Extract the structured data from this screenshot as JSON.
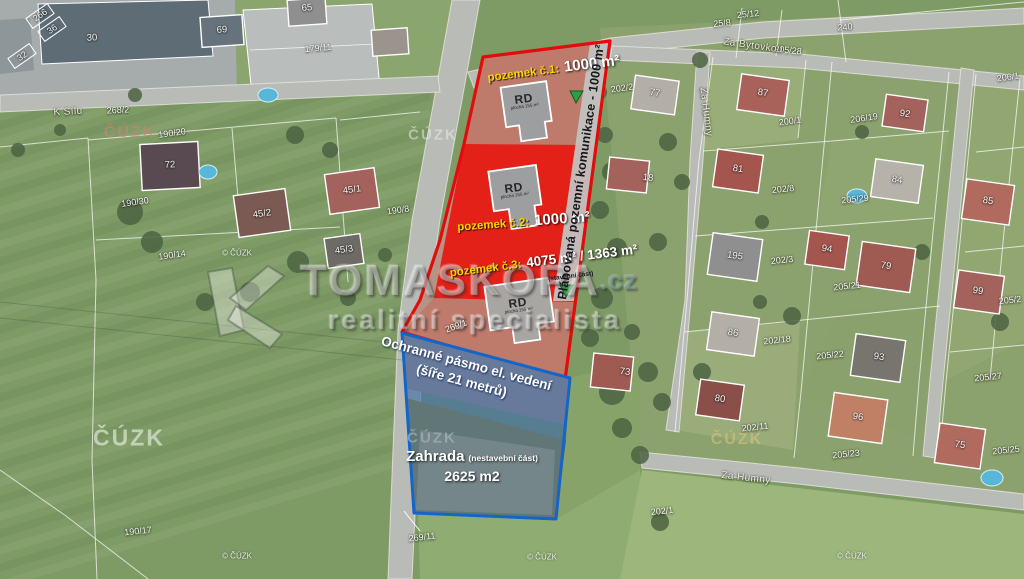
{
  "map_overlay": {
    "parcel1_label": "pozemek č.1:",
    "parcel1_area": "1000 m²",
    "parcel2_label": "pozemek č.2:",
    "parcel2_area": "1000 m²",
    "parcel3_label": "pozemek č.3:",
    "parcel3_area": "4075 m² / 1363 m²",
    "parcel3_note": "(stavební část)",
    "planned_road_label": "Plánovaná pozemní komunikace - 1000 m²",
    "easement_line1": "Ochranné pásmo el. vedení",
    "easement_line2": "(šíře 21 metrů)",
    "garden_title": "Zahrada",
    "garden_note": "(nestavební část)",
    "garden_area": "2625 m2",
    "building_label": "RD",
    "building_sublabel": "plocha 155 m²",
    "colors": {
      "parcel_outline": "#e30c0c",
      "parcel2_fill": "#e32119",
      "garden_outline": "#1565c8",
      "road_strip": "#c2c2c0",
      "marker_green": "#2e9e41",
      "label_yellow": "#ffd400"
    }
  },
  "watermark": {
    "brand": "TOMASKOPA",
    "tld": ".cz",
    "tagline": "realitní specialista"
  },
  "cuzk": {
    "watermark_text": "ČÚZK",
    "copyright_text": "© ČÚZK",
    "watermark_positions": [
      {
        "x": 130,
        "y": 133,
        "size": 16,
        "color": "rgba(205,130,120,0.6)"
      },
      {
        "x": 433,
        "y": 135,
        "size": 15,
        "color": "rgba(240,240,240,0.5)"
      },
      {
        "x": 129,
        "y": 438,
        "size": 23,
        "color": "rgba(235,240,230,0.62)"
      },
      {
        "x": 432,
        "y": 438,
        "size": 15,
        "color": "rgba(175,185,190,0.62)"
      },
      {
        "x": 737,
        "y": 440,
        "size": 16,
        "color": "rgba(215,195,125,0.6)"
      }
    ],
    "copyright_positions": [
      {
        "x": 237,
        "y": 253
      },
      {
        "x": 237,
        "y": 556
      },
      {
        "x": 542,
        "y": 557
      },
      {
        "x": 852,
        "y": 556
      }
    ]
  },
  "cadastre": {
    "street_labels": [
      {
        "text": "Za Bytovkou",
        "x": 753,
        "y": 46,
        "rot": 8
      },
      {
        "text": "Za Humny",
        "x": 706,
        "y": 112,
        "rot": 83
      },
      {
        "text": "Za Humny",
        "x": 746,
        "y": 478,
        "rot": 6
      },
      {
        "text": "K Sílu",
        "x": 68,
        "y": 112,
        "rot": -3
      }
    ],
    "parcel_labels": [
      {
        "text": "25/12",
        "x": 748,
        "y": 14,
        "rot": -6
      },
      {
        "text": "25/8",
        "x": 722,
        "y": 23,
        "rot": -6
      },
      {
        "text": "205/28",
        "x": 788,
        "y": 50,
        "rot": 6
      },
      {
        "text": "240",
        "x": 845,
        "y": 27,
        "rot": -5
      },
      {
        "text": "202/2",
        "x": 622,
        "y": 88,
        "rot": -8
      },
      {
        "text": "200/1",
        "x": 790,
        "y": 121,
        "rot": -8
      },
      {
        "text": "206/1",
        "x": 1008,
        "y": 77,
        "rot": -8
      },
      {
        "text": "206/19",
        "x": 864,
        "y": 118,
        "rot": -8
      },
      {
        "text": "179/11",
        "x": 318,
        "y": 48,
        "rot": -5
      },
      {
        "text": "268/2",
        "x": 118,
        "y": 110,
        "rot": -3
      },
      {
        "text": "190/20",
        "x": 172,
        "y": 133,
        "rot": -8
      },
      {
        "text": "190/30",
        "x": 135,
        "y": 202,
        "rot": -8
      },
      {
        "text": "190/8",
        "x": 398,
        "y": 210,
        "rot": -8
      },
      {
        "text": "190/14",
        "x": 172,
        "y": 255,
        "rot": -8
      },
      {
        "text": "202/8",
        "x": 783,
        "y": 189,
        "rot": -6
      },
      {
        "text": "205/29",
        "x": 855,
        "y": 199,
        "rot": -6
      },
      {
        "text": "202/3",
        "x": 782,
        "y": 260,
        "rot": -6
      },
      {
        "text": "205/21",
        "x": 847,
        "y": 286,
        "rot": -6
      },
      {
        "text": "205/2",
        "x": 1010,
        "y": 300,
        "rot": -6
      },
      {
        "text": "202/18",
        "x": 777,
        "y": 340,
        "rot": -6
      },
      {
        "text": "205/22",
        "x": 830,
        "y": 355,
        "rot": -6
      },
      {
        "text": "205/27",
        "x": 988,
        "y": 377,
        "rot": -6
      },
      {
        "text": "202/11",
        "x": 755,
        "y": 427,
        "rot": -6
      },
      {
        "text": "205/23",
        "x": 846,
        "y": 454,
        "rot": -6
      },
      {
        "text": "205/25",
        "x": 1006,
        "y": 450,
        "rot": -6
      },
      {
        "text": "269/1",
        "x": 456,
        "y": 326,
        "rot": -20
      },
      {
        "text": "269/11",
        "x": 422,
        "y": 537,
        "rot": -6
      },
      {
        "text": "202/1",
        "x": 662,
        "y": 511,
        "rot": -6
      },
      {
        "text": "190/17",
        "x": 138,
        "y": 531,
        "rot": -6
      },
      {
        "text": "266",
        "x": 40,
        "y": 15,
        "rot": -35
      },
      {
        "text": "36",
        "x": 52,
        "y": 29,
        "rot": -35
      },
      {
        "text": "32",
        "x": 22,
        "y": 56,
        "rot": -35
      }
    ],
    "house_labels": [
      {
        "text": "30",
        "x": 92,
        "y": 38,
        "rot": -3
      },
      {
        "text": "69",
        "x": 222,
        "y": 30,
        "rot": -4
      },
      {
        "text": "65",
        "x": 307,
        "y": 8,
        "rot": -4
      },
      {
        "text": "72",
        "x": 170,
        "y": 165,
        "rot": -3
      },
      {
        "text": "45/1",
        "x": 352,
        "y": 190,
        "rot": -8
      },
      {
        "text": "45/2",
        "x": 262,
        "y": 214,
        "rot": -8
      },
      {
        "text": "45/3",
        "x": 344,
        "y": 250,
        "rot": -8
      },
      {
        "text": "77",
        "x": 655,
        "y": 93,
        "rot": 8
      },
      {
        "text": "87",
        "x": 763,
        "y": 93,
        "rot": 8
      },
      {
        "text": "92",
        "x": 905,
        "y": 114,
        "rot": 8
      },
      {
        "text": "18",
        "x": 648,
        "y": 178,
        "rot": 6
      },
      {
        "text": "81",
        "x": 738,
        "y": 169,
        "rot": 8
      },
      {
        "text": "84",
        "x": 897,
        "y": 180,
        "rot": 8
      },
      {
        "text": "85",
        "x": 988,
        "y": 201,
        "rot": 8
      },
      {
        "text": "195",
        "x": 735,
        "y": 256,
        "rot": 8
      },
      {
        "text": "94",
        "x": 827,
        "y": 249,
        "rot": 8
      },
      {
        "text": "79",
        "x": 886,
        "y": 266,
        "rot": 8
      },
      {
        "text": "99",
        "x": 978,
        "y": 291,
        "rot": 8
      },
      {
        "text": "86",
        "x": 733,
        "y": 333,
        "rot": 8
      },
      {
        "text": "93",
        "x": 879,
        "y": 357,
        "rot": 8
      },
      {
        "text": "73",
        "x": 625,
        "y": 372,
        "rot": 6
      },
      {
        "text": "80",
        "x": 720,
        "y": 399,
        "rot": 8
      },
      {
        "text": "96",
        "x": 858,
        "y": 417,
        "rot": 8
      },
      {
        "text": "75",
        "x": 960,
        "y": 445,
        "rot": 8
      }
    ]
  }
}
